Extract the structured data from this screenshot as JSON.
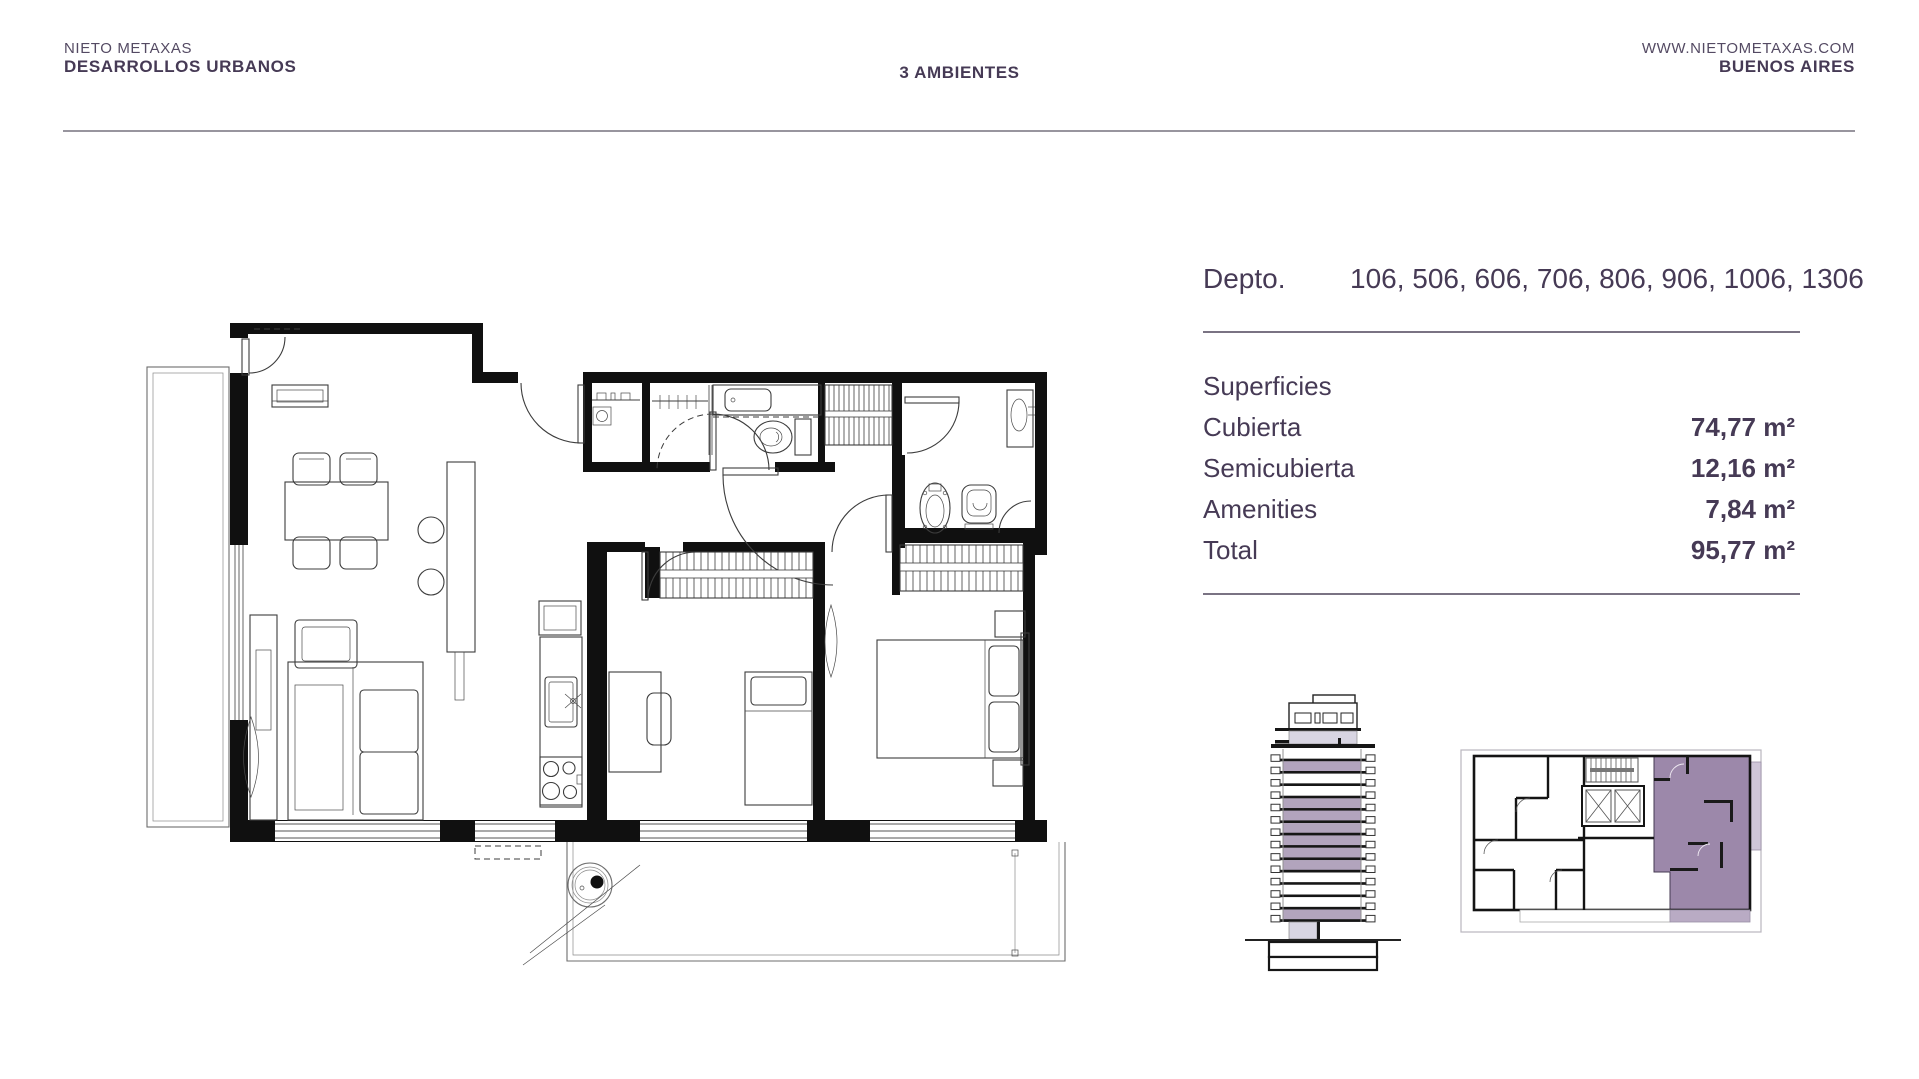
{
  "header": {
    "brand_line1": "NIETO METAXAS",
    "brand_line2": "DESARROLLOS URBANOS",
    "center_title": "3 AMBIENTES",
    "website": "WWW.NIETOMETAXAS.COM",
    "city": "BUENOS AIRES"
  },
  "unit": {
    "depto_label": "Depto.",
    "depto_numbers": "106, 506, 606, 706, 806, 906, 1006, 1306"
  },
  "surfaces": {
    "title": "Superficies",
    "rows": [
      {
        "label": "Cubierta",
        "value": "74,77 m²"
      },
      {
        "label": "Semicubierta",
        "value": "12,16 m²"
      },
      {
        "label": "Amenities",
        "value": "7,84 m²"
      },
      {
        "label": "Total",
        "value": "95,77 m²"
      }
    ]
  },
  "building": {
    "floors_top_to_bottom": [
      "white",
      "purple",
      "white",
      "white",
      "purple",
      "purple",
      "purple",
      "purple",
      "purple",
      "purple",
      "white",
      "white",
      "white",
      "purple"
    ]
  },
  "colors": {
    "text": "#463a55",
    "accent": "#9c88aa",
    "accent_light": "#b2a4bd",
    "accent_pale": "#d8d5e2",
    "divider": "#7a7383",
    "header_rule": "#98959e"
  }
}
